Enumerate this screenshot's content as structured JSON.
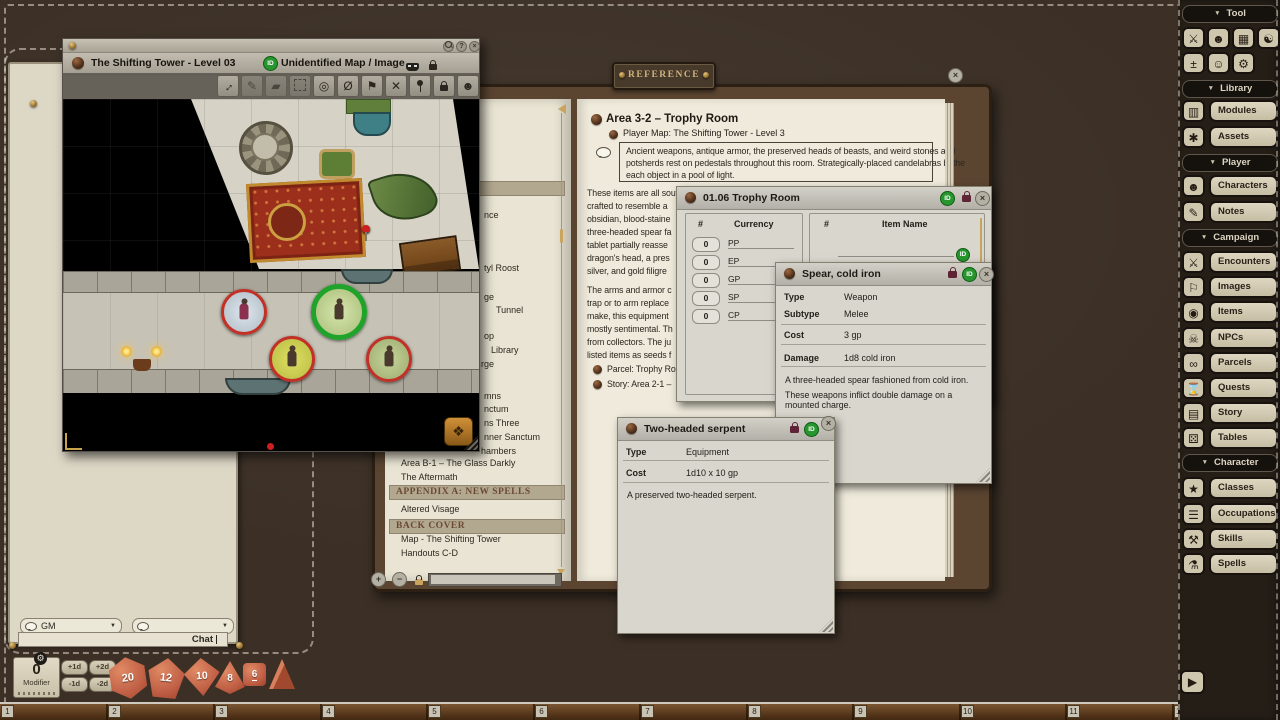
{
  "badges": {
    "id": "ID"
  },
  "sidebar": {
    "tool_label": "Tool",
    "library_label": "Library",
    "player_label": "Player",
    "campaign_label": "Campaign",
    "character_label": "Character",
    "library_buttons": [
      {
        "label": "Modules"
      },
      {
        "label": "Assets"
      }
    ],
    "player_buttons": [
      {
        "label": "Characters"
      },
      {
        "label": "Notes"
      }
    ],
    "campaign_buttons": [
      {
        "label": "Encounters"
      },
      {
        "label": "Images"
      },
      {
        "label": "Items"
      },
      {
        "label": "NPCs"
      },
      {
        "label": "Parcels"
      },
      {
        "label": "Quests"
      },
      {
        "label": "Story"
      },
      {
        "label": "Tables"
      }
    ],
    "character_buttons": [
      {
        "label": "Classes"
      },
      {
        "label": "Occupations"
      },
      {
        "label": "Skills"
      },
      {
        "label": "Spells"
      }
    ]
  },
  "map_window": {
    "title": "The Shifting Tower - Level 03",
    "subtitle": "Unidentified Map / Image",
    "controls": {
      "help": "?",
      "close": "×"
    }
  },
  "reference": {
    "plaque": "REFERENCE"
  },
  "story_page": {
    "heading": "Area 3-2 – Trophy Room",
    "map_link": "Player Map: The Shifting Tower - Level 3",
    "readaloud_lines": [
      "Ancient weapons, antique armor, the preserved heads of beasts, and weird stones and",
      "potsherds rest on pedestals throughout this room. Strategically-placed candelabras bathe",
      "each object in a pool of light."
    ],
    "para1_lines": [
      "These items are all souvenirs of Emirikol's past exploits. The room contains a suit of plate armor",
      "crafted to resemble a",
      "obsidian, blood-staine",
      "three-headed spear fa",
      "tablet partially reasse",
      "dragon's head, a pres",
      "silver, and gold filigre"
    ],
    "para2_lines": [
      "The arms and armor c",
      "trap or to arm replace",
      "make, this equipment",
      "mostly sentimental. Th",
      "from collectors. The ju",
      "listed items as seeds f"
    ],
    "links": [
      "Parcel: Trophy Ro",
      "Story: Area 2-1 –"
    ]
  },
  "story_controls": {
    "zoom_in": "+",
    "zoom_out": "−"
  },
  "toc": {
    "fragments": [
      "nce",
      "tyl Roost",
      "ge",
      "Tunnel",
      "op",
      "Library",
      "rge",
      "mns",
      "nctum",
      "ns Three",
      "nner Sanctum",
      "hambers"
    ],
    "items": [
      "Area B-1 – The Glass Darkly",
      "The Aftermath",
      "Altered Visage",
      "Map - The Shifting Tower",
      "Handouts C-D"
    ],
    "headers": [
      "APPENDIX A: NEW SPELLS",
      "BACK COVER"
    ]
  },
  "parcel_window": {
    "title": "01.06 Trophy Room",
    "num_header": "#",
    "currency_header": "Currency",
    "item_header": "Item Name",
    "currency_rows": [
      {
        "qty": "0",
        "code": "PP"
      },
      {
        "qty": "0",
        "code": "EP"
      },
      {
        "qty": "0",
        "code": "GP"
      },
      {
        "qty": "0",
        "code": "SP"
      },
      {
        "qty": "0",
        "code": "CP"
      }
    ],
    "item_rows": [
      {
        "qty": "1",
        "name": "Dinosaur hide armor"
      }
    ]
  },
  "spear_window": {
    "title": "Spear, cold iron",
    "fields": [
      {
        "label": "Type",
        "value": "Weapon"
      },
      {
        "label": "Subtype",
        "value": "Melee"
      },
      {
        "label": "Cost",
        "value": "3 gp"
      },
      {
        "label": "Damage",
        "value": "1d8 cold iron"
      }
    ],
    "desc1": "A three-headed spear fashioned from cold iron.",
    "desc2": "These weapons inflict double damage on a mounted charge."
  },
  "serpent_window": {
    "title": "Two-headed serpent",
    "fields": [
      {
        "label": "Type",
        "value": "Equipment"
      },
      {
        "label": "Cost",
        "value": "1d10 x 10 gp"
      }
    ],
    "desc": "A preserved two-headed serpent."
  },
  "chat": {
    "speaker": "GM",
    "entry": "Chat"
  },
  "dice_tray": {
    "modifier_value": "0",
    "modifier_label": "Modifier",
    "chain_buttons": [
      "+1d",
      "+2d",
      "-1d",
      "-2d"
    ],
    "dice": [
      {
        "label": "20"
      },
      {
        "label": "12"
      },
      {
        "label": "10"
      },
      {
        "label": "8"
      },
      {
        "label": "6"
      }
    ]
  },
  "ruler": {
    "numbers": [
      "1",
      "2",
      "3",
      "4",
      "5",
      "6",
      "7",
      "8",
      "9",
      "10",
      "11",
      "12"
    ]
  },
  "colors": {
    "id_green": "#27962e",
    "token_ring_red": "#c23127",
    "token_ring_green": "#1fa32a",
    "dice_orange": "#c05f45",
    "leather": "#3c3026",
    "parchment": "#efeadb"
  }
}
